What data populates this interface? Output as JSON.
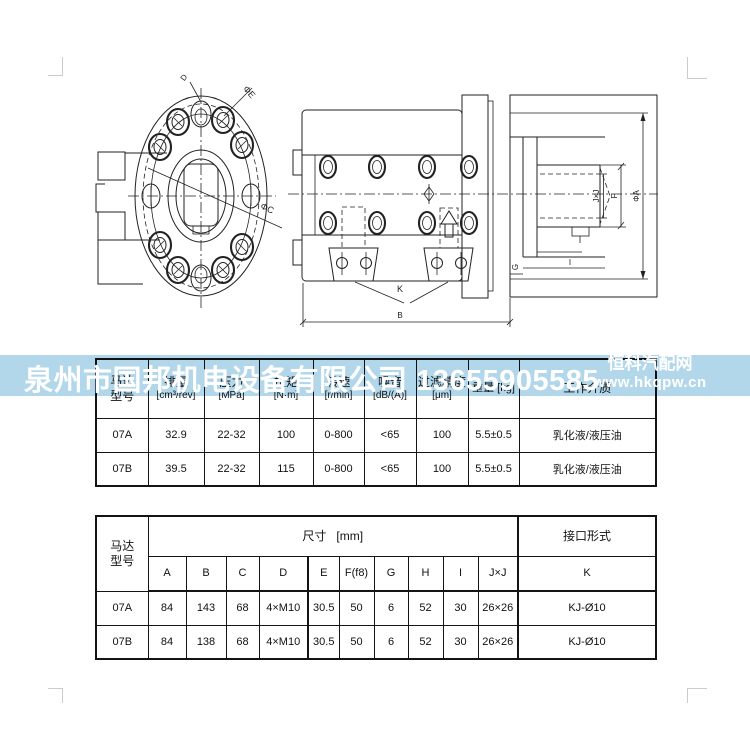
{
  "watermark": {
    "company": "泉州市国邦机电设备有限公司",
    "phone": "13655905585",
    "site_name": "恒科汽配网",
    "site_url": "www.hkqpw.cn",
    "band_color": "#b2d7ea",
    "text_color": "#ffffff"
  },
  "spec_table": {
    "headers": [
      {
        "line1": "马达",
        "line2": "型号"
      },
      {
        "line1": "排量",
        "line2": "[cm³/rev]"
      },
      {
        "line1": "压力",
        "line2": "[MPa]"
      },
      {
        "line1": "扭矩",
        "line2": "[N·m]"
      },
      {
        "line1": "转速",
        "line2": "[r/min]"
      },
      {
        "line1": "噪音",
        "line2": "[dB/(A)]"
      },
      {
        "line1": "过滤精度",
        "line2": "[μm]"
      },
      {
        "line1": "重量 [kg]",
        "line2": ""
      },
      {
        "line1": "工作介质",
        "line2": ""
      }
    ],
    "rows": [
      [
        "07A",
        "32.9",
        "22-32",
        "100",
        "0-800",
        "<65",
        "100",
        "5.5±0.5",
        "乳化液/液压油"
      ],
      [
        "07B",
        "39.5",
        "22-32",
        "115",
        "0-800",
        "<65",
        "100",
        "5.5±0.5",
        "乳化液/液压油"
      ]
    ]
  },
  "dimension_table": {
    "model_header_line1": "马达",
    "model_header_line2": "型号",
    "size_header": "尺寸",
    "size_unit": "[mm]",
    "port_header": "接口形式",
    "columns": [
      "A",
      "B",
      "C",
      "D",
      "E",
      "F(f8)",
      "G",
      "H",
      "I",
      "J×J",
      "K"
    ],
    "rows": [
      [
        "07A",
        "84",
        "143",
        "68",
        "4×M10",
        "30.5",
        "50",
        "6",
        "52",
        "30",
        "26×26",
        "KJ-Ø10"
      ],
      [
        "07B",
        "84",
        "138",
        "68",
        "4×M10",
        "30.5",
        "50",
        "6",
        "52",
        "30",
        "26×26",
        "KJ-Ø10"
      ]
    ]
  },
  "drawing": {
    "labels": {
      "phi_c": "ΦC",
      "phi_e": "ΦE",
      "d": "D",
      "k": "K",
      "b": "B",
      "g": "G",
      "i": "I",
      "jxj": "J×J",
      "f": "F",
      "phi_a": "ΦA"
    }
  }
}
